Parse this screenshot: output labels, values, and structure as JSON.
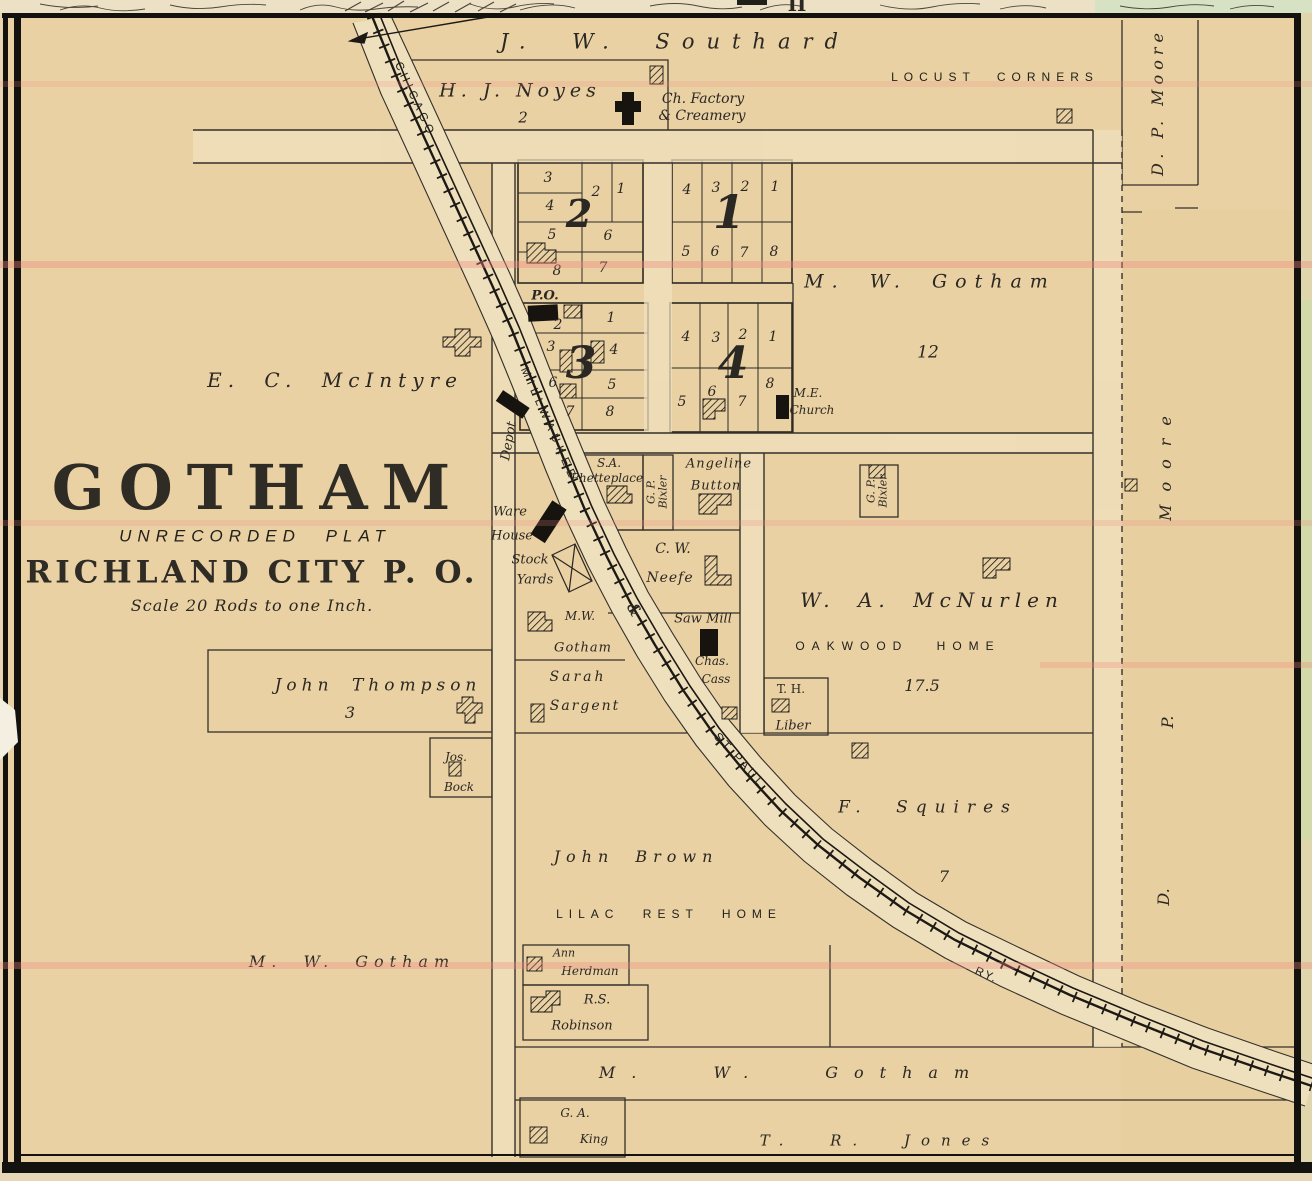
{
  "palette": {
    "paper": "#e9d1a4",
    "street": "#efe0bd",
    "ink": "#2b2722",
    "building": "#17140f",
    "scan_line_pink": "#ef8a7e",
    "margin_paper": "#ece1c4",
    "margin_green": "#d6e2c3"
  },
  "margin": {
    "mark": "II"
  },
  "title": {
    "name": "GOTHAM",
    "subtitle": "UNRECORDED PLAT",
    "post_office": "RICHLAND CITY P. O.",
    "scale_note": "Scale 20 Rods to one Inch."
  },
  "railroad": {
    "chicago": "CHICAGO",
    "milwaukee": "MILLWAUKEE",
    "ampersand": "&",
    "st_paul": "ST PAUL",
    "ry": "RY."
  },
  "features": {
    "post_office": "P.O.",
    "depot": "Depot",
    "warehouse_1": "Ware",
    "warehouse_2": "House",
    "stockyards_1": "Stock",
    "stockyards_2": "Yards",
    "sawmill": "Saw Mill",
    "factory_1": "Ch. Factory",
    "factory_2": "& Creamery",
    "church_1": "M.E.",
    "church_2": "Church",
    "locust_corners": "LOCUST CORNERS",
    "oakwood_home": "OAKWOOD HOME",
    "lilac_rest_home": "LILAC REST HOME"
  },
  "owners": {
    "southard": "J. W. Southard",
    "noyes": "H. J. Noyes",
    "noyes_acres": "2",
    "dp_moore_top": "D. P. Moore",
    "dp_moore_right_d": "D.",
    "dp_moore_right_p": "P.",
    "dp_moore_right_moore": "Moore",
    "gotham_12": "M. W. Gotham",
    "gotham_12_acres": "12",
    "mcintyre": "E. C. McIntyre",
    "phetteplace_1": "S.A.",
    "phetteplace_2": "Phetteplace",
    "bixler_1": "G. P.",
    "bixler_2": "Bixler",
    "angeline_1": "Angeline",
    "angeline_2": "Button",
    "neefe_1": "C. W.",
    "neefe_2": "Neefe",
    "cass_1": "Chas.",
    "cass_2": "Cass",
    "liber_1": "T. H.",
    "liber_2": "Liber",
    "mcnurlen": "W. A. McNurlen",
    "mcnurlen_acres": "17.5",
    "gotham_small_1": "M.W.",
    "gotham_small_2": "Gotham",
    "sargent_1": "Sarah",
    "sargent_2": "Sargent",
    "thompson": "John Thompson",
    "thompson_acres": "3",
    "bock_1": "Jos.",
    "bock_2": "Bock",
    "brown": "John Brown",
    "squires": "F. Squires",
    "squires_acres": "7",
    "gotham_left": "M. W. Gotham",
    "herdman_1": "Ann",
    "herdman_2": "Herdman",
    "robinson_1": "R.S.",
    "robinson_2": "Robinson",
    "gotham_bottom": "M. W. Gotham",
    "king_1": "G. A.",
    "king_2": "King",
    "jones": "T. R. Jones"
  },
  "blocks": {
    "b1": {
      "number": "1",
      "lots": [
        "4",
        "3",
        "2",
        "1",
        "5",
        "6",
        "7",
        "8"
      ]
    },
    "b2": {
      "number": "2",
      "lots": [
        "3",
        "2",
        "1",
        "4",
        "5",
        "6",
        "8",
        "7"
      ]
    },
    "b3": {
      "number": "3",
      "lots": [
        "2",
        "1",
        "3",
        "4",
        "6",
        "5",
        "7",
        "8"
      ]
    },
    "b4": {
      "number": "4",
      "lots": [
        "4",
        "3",
        "2",
        "1",
        "5",
        "6",
        "7",
        "8"
      ]
    }
  }
}
